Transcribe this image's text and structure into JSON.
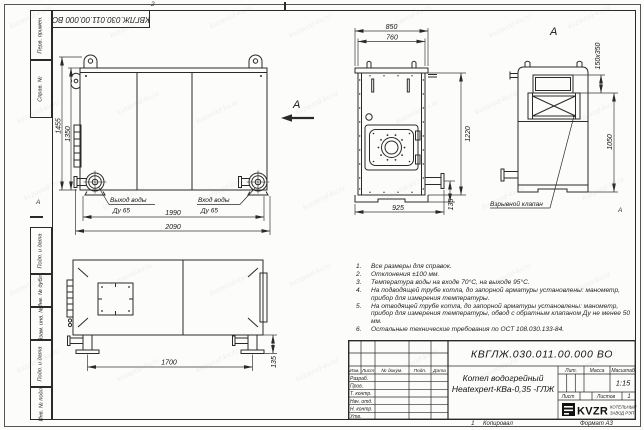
{
  "page": {
    "watermark_text": "kvzavod-kv.ru"
  },
  "frame": {
    "doc_number_top": "КВГЛЖ.030.011.00.000 ВО",
    "zone_markers": {
      "top": "2",
      "left": "А",
      "bottom": "1",
      "right": "А"
    },
    "sidebar_top": [
      {
        "label": "Перв. примен."
      },
      {
        "label": "Справ. №"
      }
    ],
    "sidebar_bottom": [
      {
        "label": "Подп. и дата"
      },
      {
        "label": "Инв. № дубл."
      },
      {
        "label": "Взам. инв. №"
      },
      {
        "label": "Подп. и дата"
      },
      {
        "label": "Инв. № подл."
      }
    ]
  },
  "views": {
    "side": {
      "dim_overall_height": "1455",
      "dim_body_height": "1350",
      "dim_ports_span": "1990",
      "dim_overall_length": "2090",
      "outlet_line1": "Выход воды",
      "outlet_line2": "Ду 65",
      "inlet_line1": "Вход воды",
      "inlet_line2": "Ду 65",
      "view_arrow_label": "А"
    },
    "front": {
      "dim_overall_width": "850",
      "dim_body_width": "760",
      "dim_height": "1220",
      "dim_base_width": "925",
      "dim_flange_offset": "135"
    },
    "rear": {
      "view_label": "А",
      "dim_valve_size": "150х350",
      "dim_valve_height": "1050",
      "valve_label": "Взрывной клапан"
    },
    "top": {
      "dim_support_span": "1700",
      "dim_base_height": "135"
    }
  },
  "notes": {
    "items": [
      {
        "num": "1.",
        "text": "Все размеры для справок."
      },
      {
        "num": "2.",
        "text": "Отклонения ±100 мм."
      },
      {
        "num": "3.",
        "text": "Температура воды на входе 70°С, на выходе 95°С."
      },
      {
        "num": "4.",
        "text": "На подводящей трубе котла, до запорной арматуры установлены: манометр, прибор для измерения температуры."
      },
      {
        "num": "5.",
        "text": "На отводящей трубе котла, до запорной арматуры установлены: манометр, прибор для измерения температуры, обвод с обратным клапаном Ду не менее 50 мм."
      },
      {
        "num": "6.",
        "text": "Остальные технические требования по ОСТ 108.030.133-84."
      }
    ]
  },
  "title_block": {
    "doc_number": "КВГЛЖ.030.011.00.000 ВО",
    "title_line1": "Котел водогрейный",
    "title_line2": "Heatexpert-КВа-0,35 -ГЛЖ",
    "header_cols": [
      "Изм.",
      "Лист",
      "№ докум.",
      "Подп.",
      "Дата"
    ],
    "rows": [
      "Разраб.",
      "Пров.",
      "Т. контр.",
      "Нач. отд.",
      "Н. контр.",
      "Утв."
    ],
    "lit_label": "Лит.",
    "mass_label": "Масса",
    "scale_label": "Масштаб",
    "scale_value": "1:15",
    "sheet_label": "Лист",
    "sheets_label": "Листов",
    "sheets_value": "1",
    "company": {
      "logo_text": "KVZR",
      "name_line1": "КОТЕЛЬНЫЙ",
      "name_line2": "ЗАВОД РЭП"
    },
    "copied_label": "Копировал",
    "format_label": "Формат А3"
  }
}
